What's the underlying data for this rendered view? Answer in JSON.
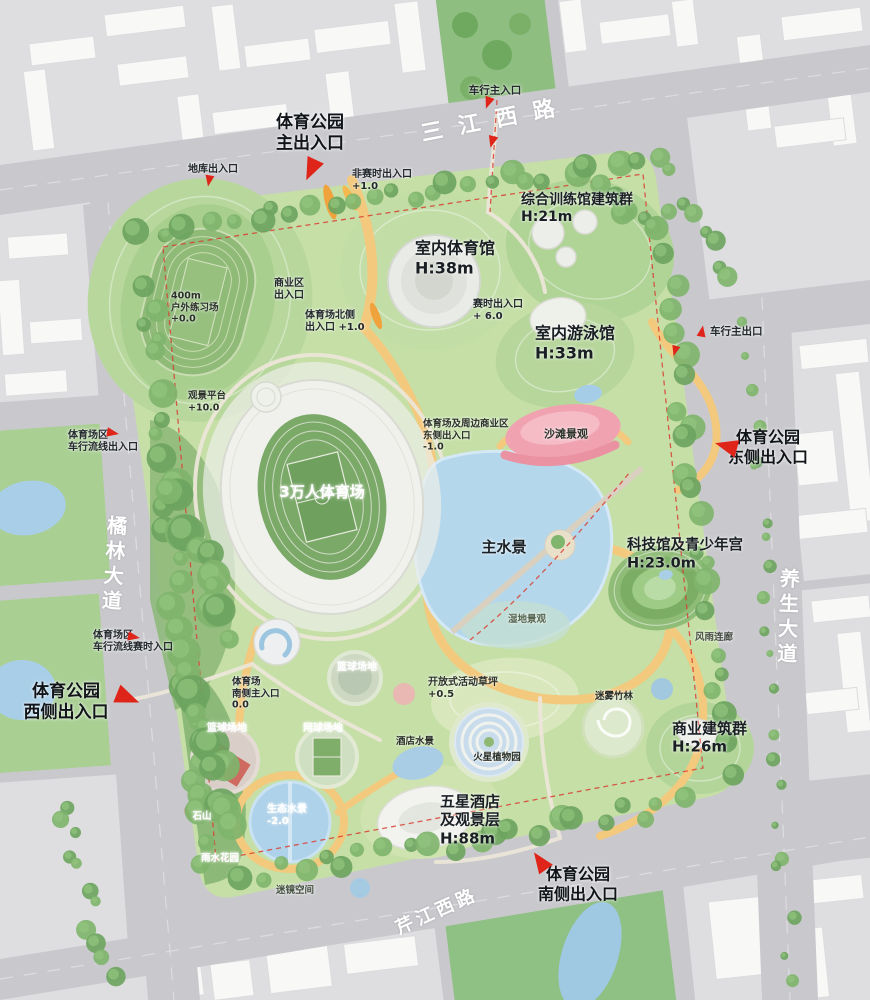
{
  "colors": {
    "road": "#c9c9cd",
    "block": "#dedee1",
    "building": "#f8f8f7",
    "park_base": "#c5dfa6",
    "water": "#b4d7ec",
    "path_orange": "#f3c97d",
    "sand_pink": "#f0a2b0",
    "accent_red": "#df241a",
    "tree_dark": "#6da45f"
  },
  "road_labels": [
    {
      "name": "road-label-sanjiang-xilu",
      "text": "三江西路",
      "x": 496,
      "y": 121,
      "rotate": -11,
      "size": 22,
      "spacing": 16
    },
    {
      "name": "road-label-julin-dadao",
      "text": "橘林大道",
      "x": 113,
      "y": 565,
      "rotate": 4,
      "size": 20,
      "vertical": true
    },
    {
      "name": "road-label-yangsheng-dadao",
      "text": "养生大道",
      "x": 787,
      "y": 618,
      "rotate": 2,
      "size": 20,
      "vertical": true
    },
    {
      "name": "road-label-qinjiang-xilu",
      "text": "芹江西路",
      "x": 437,
      "y": 912,
      "rotate": -24,
      "size": 18,
      "spacing": 4
    }
  ],
  "entrances_major": [
    {
      "name": "entrance-main-north",
      "lines": [
        "体育公园",
        "主出入口"
      ],
      "x": 310,
      "y": 133,
      "size": 17
    },
    {
      "name": "entrance-east",
      "lines": [
        "体育公园",
        "东侧出入口"
      ],
      "x": 768,
      "y": 447,
      "size": 16
    },
    {
      "name": "entrance-west",
      "lines": [
        "体育公园",
        "西侧出入口"
      ],
      "x": 66,
      "y": 702,
      "size": 17
    },
    {
      "name": "entrance-south",
      "lines": [
        "体育公园",
        "南侧出入口"
      ],
      "x": 578,
      "y": 884,
      "size": 16
    }
  ],
  "entrances_minor": [
    {
      "name": "entrance-vehicle-main-north",
      "lines": [
        "车行主入口"
      ],
      "x": 495,
      "y": 91,
      "size": 10.5
    },
    {
      "name": "entrance-garage",
      "lines": [
        "地库出入口"
      ],
      "x": 213,
      "y": 170,
      "size": 10
    },
    {
      "name": "entrance-non-event",
      "lines": [
        "非赛时出入口",
        "+1.0"
      ],
      "x": 352,
      "y": 181,
      "size": 10,
      "align": "left"
    },
    {
      "name": "entrance-event",
      "lines": [
        "赛时出入口",
        "+ 6.0"
      ],
      "x": 473,
      "y": 311,
      "size": 10,
      "align": "left"
    },
    {
      "name": "entrance-commercial-area",
      "lines": [
        "商业区",
        "出入口"
      ],
      "x": 289,
      "y": 290,
      "size": 10
    },
    {
      "name": "entrance-stadium-north",
      "lines": [
        "体育场北侧",
        "出入口 +1.0"
      ],
      "x": 305,
      "y": 322,
      "size": 10,
      "align": "left"
    },
    {
      "name": "entrance-stadium-vehicle-west",
      "lines": [
        "体育场区",
        "车行流线出入口"
      ],
      "x": 68,
      "y": 442,
      "size": 10,
      "align": "left"
    },
    {
      "name": "entrance-stadium-vehicle-event",
      "lines": [
        "体育场区",
        "车行流线赛时入口"
      ],
      "x": 93,
      "y": 642,
      "size": 10,
      "align": "left"
    },
    {
      "name": "entrance-vehicle-main-east",
      "lines": [
        "车行主出口"
      ],
      "x": 710,
      "y": 332,
      "size": 10.5,
      "align": "left"
    },
    {
      "name": "entrance-stadium-south",
      "lines": [
        "体育场",
        "南侧主入口",
        "0.0"
      ],
      "x": 232,
      "y": 694,
      "size": 9.5,
      "align": "left"
    }
  ],
  "venues": [
    {
      "name": "venue-training-complex",
      "lines": [
        "综合训练馆建筑群",
        "H:21m"
      ],
      "x": 521,
      "y": 209,
      "size": 14,
      "align": "left"
    },
    {
      "name": "venue-indoor-gym",
      "lines": [
        "室内体育馆",
        "H:38m"
      ],
      "x": 415,
      "y": 258,
      "size": 16,
      "align": "left"
    },
    {
      "name": "venue-swimming-hall",
      "lines": [
        "室内游泳馆",
        "H:33m"
      ],
      "x": 535,
      "y": 343,
      "size": 16,
      "align": "left"
    },
    {
      "name": "venue-science-youth-palace",
      "lines": [
        "科技馆及青少年宫",
        "H:23.0m"
      ],
      "x": 627,
      "y": 555,
      "size": 14.5,
      "align": "left"
    },
    {
      "name": "venue-commercial-group",
      "lines": [
        "商业建筑群",
        "H:26m"
      ],
      "x": 672,
      "y": 738,
      "size": 15,
      "align": "left"
    },
    {
      "name": "venue-hotel",
      "lines": [
        "五星酒店",
        "及观景层",
        "H:88m"
      ],
      "x": 440,
      "y": 820,
      "size": 15,
      "align": "left"
    },
    {
      "name": "venue-stadium",
      "lines": [
        "3万人体育场"
      ],
      "x": 322,
      "y": 492,
      "size": 15,
      "color": "#ffffff"
    },
    {
      "name": "label-main-water",
      "lines": [
        "主水景"
      ],
      "x": 504,
      "y": 547,
      "size": 15
    }
  ],
  "features": [
    {
      "name": "feature-practice-field-400m",
      "lines": [
        "400m",
        "户外练习场",
        "+0.0"
      ],
      "x": 171,
      "y": 308,
      "size": 9.5,
      "align": "left"
    },
    {
      "name": "feature-viewing-platform",
      "lines": [
        "观景平台",
        "+10.0"
      ],
      "x": 188,
      "y": 402,
      "size": 9.5,
      "align": "left"
    },
    {
      "name": "feature-stadium-commercial-east",
      "lines": [
        "体育场及周边商业区",
        "东侧出入口",
        "-1.0"
      ],
      "x": 423,
      "y": 436,
      "size": 9.5,
      "align": "left"
    },
    {
      "name": "feature-beach-landscape",
      "lines": [
        "沙滩景观"
      ],
      "x": 566,
      "y": 434,
      "size": 11
    },
    {
      "name": "feature-wetland",
      "lines": [
        "湿地景观"
      ],
      "x": 527,
      "y": 620,
      "size": 9.5,
      "color": "#55654f"
    },
    {
      "name": "feature-rain-corridor",
      "lines": [
        "风雨连廊"
      ],
      "x": 714,
      "y": 638,
      "size": 9.5,
      "color": "#474d45"
    },
    {
      "name": "feature-basketball-upper",
      "lines": [
        "篮球场地"
      ],
      "x": 357,
      "y": 668,
      "size": 10,
      "color": "#ffffff"
    },
    {
      "name": "feature-open-lawn",
      "lines": [
        "开放式活动草坪",
        "+0.5"
      ],
      "x": 428,
      "y": 689,
      "size": 10,
      "align": "left"
    },
    {
      "name": "feature-mist-bamboo",
      "lines": [
        "迷雾竹林"
      ],
      "x": 614,
      "y": 697,
      "size": 9.5
    },
    {
      "name": "feature-basketball",
      "lines": [
        "篮球场地"
      ],
      "x": 227,
      "y": 729,
      "size": 10,
      "color": "#ffffff"
    },
    {
      "name": "feature-tennis",
      "lines": [
        "网球场地"
      ],
      "x": 323,
      "y": 729,
      "size": 10,
      "color": "#ffffff"
    },
    {
      "name": "feature-hotel-water",
      "lines": [
        "酒店水景"
      ],
      "x": 415,
      "y": 742,
      "size": 9.5
    },
    {
      "name": "feature-mars-botanic-garden",
      "lines": [
        "火星植物园"
      ],
      "x": 497,
      "y": 758,
      "size": 9.5
    },
    {
      "name": "feature-rock-hill",
      "lines": [
        "石山"
      ],
      "x": 202,
      "y": 817,
      "size": 9.5,
      "color": "#ffffff"
    },
    {
      "name": "feature-eco-water",
      "lines": [
        "生态水景",
        "-2.0"
      ],
      "x": 267,
      "y": 816,
      "size": 10,
      "align": "left",
      "color": "#ffffff"
    },
    {
      "name": "feature-rain-garden",
      "lines": [
        "雨水花园"
      ],
      "x": 220,
      "y": 859,
      "size": 9.5,
      "color": "#ffffff"
    },
    {
      "name": "feature-mirror-space",
      "lines": [
        "迷镜空间"
      ],
      "x": 295,
      "y": 891,
      "size": 9.5,
      "color": "#43503f"
    }
  ],
  "arrows": [
    {
      "name": "arrow-main-entrance",
      "x": 311,
      "y": 170,
      "rotate": 205,
      "scale": 1.5
    },
    {
      "name": "arrow-vehicle-north",
      "x": 488,
      "y": 103,
      "rotate": 200,
      "scale": 0.8
    },
    {
      "name": "arrow-vehicle-north-2",
      "x": 492,
      "y": 142,
      "rotate": 195,
      "scale": 0.8
    },
    {
      "name": "arrow-garage",
      "x": 209,
      "y": 181,
      "rotate": 190,
      "scale": 0.75
    },
    {
      "name": "arrow-east-entrance",
      "x": 726,
      "y": 446,
      "rotate": -75,
      "scale": 1.5
    },
    {
      "name": "arrow-vehicle-east",
      "x": 702,
      "y": 331,
      "rotate": 10,
      "scale": 0.75
    },
    {
      "name": "arrow-east-path",
      "x": 675,
      "y": 351,
      "rotate": 195,
      "scale": 0.7
    },
    {
      "name": "arrow-west-entrance",
      "x": 128,
      "y": 698,
      "rotate": 112,
      "scale": 1.6
    },
    {
      "name": "arrow-stadium-vehicle-west",
      "x": 113,
      "y": 433,
      "rotate": 100,
      "scale": 0.8
    },
    {
      "name": "arrow-stadium-vehicle-event",
      "x": 134,
      "y": 637,
      "rotate": 100,
      "scale": 0.8
    },
    {
      "name": "arrow-south-entrance",
      "x": 540,
      "y": 861,
      "rotate": -35,
      "scale": 1.4
    }
  ]
}
